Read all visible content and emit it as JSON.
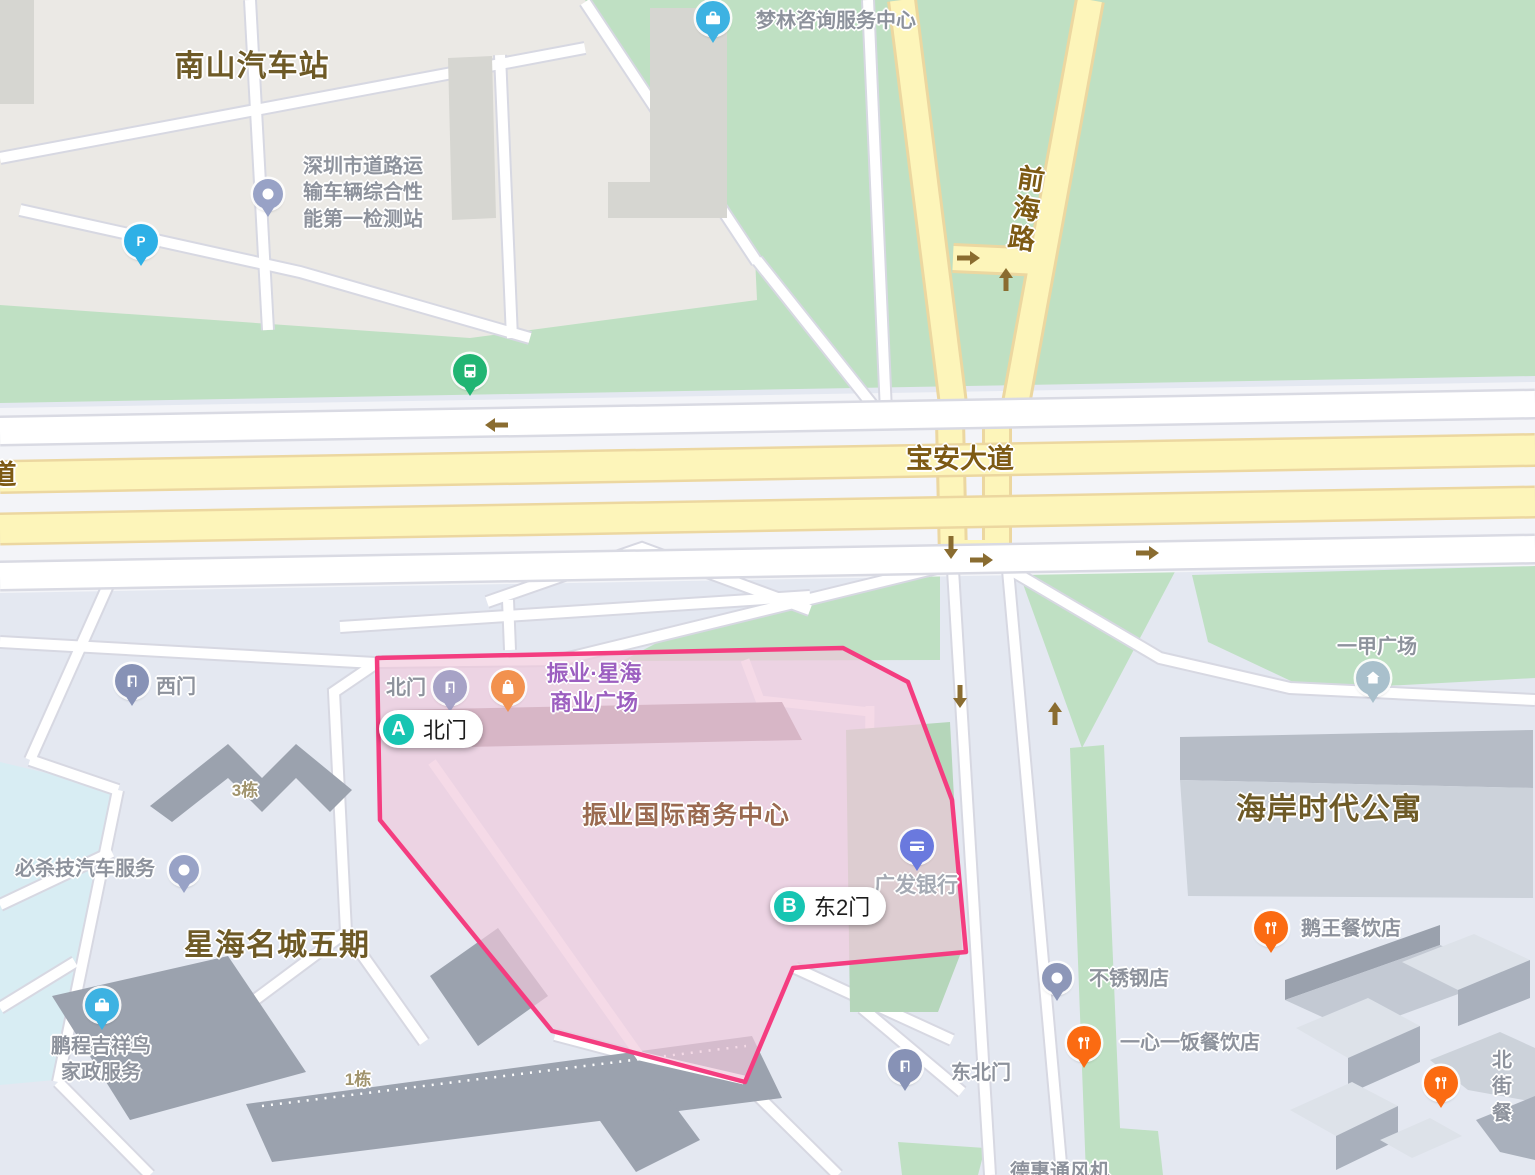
{
  "map": {
    "colors": {
      "selection_border": "#f43d80",
      "selection_fill": "#f0c8dc",
      "route_badge_teal": "#17c5b2",
      "green_area": "#bfe0c3",
      "yellow_road": "#fdf5ba",
      "brown_label": "#6e5a26"
    },
    "selected_area": {
      "name": "振业国际商务中心"
    },
    "labels": [
      {
        "name": "nanshan-bus-station",
        "text": "南山汽车站",
        "x": 252,
        "y": 67,
        "cls": "lbl-brown"
      },
      {
        "name": "baoan-avenue-road",
        "text": "宝安大道",
        "x": 960,
        "y": 460,
        "cls": "lbl-road"
      },
      {
        "name": "qianhai-road",
        "text": "前海路",
        "x": 1023,
        "y": 209,
        "cls": "lbl-road vert"
      },
      {
        "name": "partial-road-char",
        "text": "道",
        "x": 3,
        "y": 476,
        "cls": "lbl-road"
      },
      {
        "name": "zhenye-intl-business-center",
        "text": "振业国际商务中心",
        "x": 686,
        "y": 816,
        "cls": "lbl-redbrown"
      },
      {
        "name": "xinghai-mingcheng-phase5",
        "text": "星海名城五期",
        "x": 277,
        "y": 946,
        "cls": "lbl-brown"
      },
      {
        "name": "haian-times-apartment",
        "text": "海岸时代公寓",
        "x": 1329,
        "y": 810,
        "cls": "lbl-brown"
      },
      {
        "name": "building-3",
        "text": "3栋",
        "x": 245,
        "y": 791,
        "cls": "lbl-tan"
      },
      {
        "name": "building-1",
        "text": "1栋",
        "x": 358,
        "y": 1080,
        "cls": "lbl-tan"
      },
      {
        "name": "dehui-ventilator",
        "text": "德惠通风机",
        "x": 1060,
        "y": 1172,
        "cls": "lbl-gray"
      }
    ],
    "pois": [
      {
        "name": "menglin-consulting",
        "icon": "briefcase",
        "color": "#3db2e2",
        "x": 713,
        "y": 45,
        "label": "梦林咨询服务中心",
        "lx": 836,
        "ly": 21,
        "lcls": "lbl-gray"
      },
      {
        "name": "vehicle-inspection-station",
        "icon": "dot",
        "color": "#98a2c6",
        "small": true,
        "x": 268,
        "y": 219,
        "label": "深圳市道路运\n输车辆综合性\n能第一检测站",
        "lx": 363,
        "ly": 193,
        "lcls": "lbl-gray"
      },
      {
        "name": "parking",
        "icon": "P",
        "color": "#2eb0e6",
        "x": 141,
        "y": 268,
        "label": ""
      },
      {
        "name": "bus-stop",
        "icon": "bus",
        "color": "#21b573",
        "x": 470,
        "y": 398,
        "label": ""
      },
      {
        "name": "zhenye-xinghai-plaza",
        "icon": "bag",
        "color": "#f2914e",
        "x": 508,
        "y": 714,
        "label": "振业·星海\n商业广场",
        "lx": 594,
        "ly": 688,
        "lcls": "lbl-purple"
      },
      {
        "name": "north-gate",
        "icon": "door",
        "color": "#a6a2c6",
        "x": 450,
        "y": 714,
        "label": "北门",
        "lx": 406,
        "ly": 688,
        "lcls": "lbl-gray"
      },
      {
        "name": "west-gate",
        "icon": "door",
        "color": "#8792b6",
        "x": 132,
        "y": 708,
        "label": "西门",
        "lx": 176,
        "ly": 687,
        "lcls": "lbl-gray"
      },
      {
        "name": "guangfa-bank",
        "icon": "card",
        "color": "#6a79de",
        "x": 917,
        "y": 873,
        "label": "广发银行",
        "lx": 916,
        "ly": 886,
        "lcls": "lbl-lightgray"
      },
      {
        "name": "bishaji-auto-service",
        "icon": "dot",
        "color": "#98a2c6",
        "small": true,
        "x": 184,
        "y": 895,
        "label": "必杀技汽车服务",
        "lx": 85,
        "ly": 869,
        "lcls": "lbl-gray"
      },
      {
        "name": "pengcheng-housekeeping",
        "icon": "briefcase",
        "color": "#3db2e2",
        "x": 102,
        "y": 1032,
        "label": "鹏程吉祥鸟\n家政服务",
        "lx": 101,
        "ly": 1060,
        "lcls": "lbl-gray"
      },
      {
        "name": "northeast-gate",
        "icon": "door",
        "color": "#8792b6",
        "x": 905,
        "y": 1093,
        "label": "东北门",
        "lx": 981,
        "ly": 1073,
        "lcls": "lbl-gray"
      },
      {
        "name": "stainless-steel-shop",
        "icon": "dot",
        "color": "#8d97b8",
        "small": true,
        "x": 1057,
        "y": 1003,
        "label": "不锈钢店",
        "lx": 1129,
        "ly": 979,
        "lcls": "lbl-gray"
      },
      {
        "name": "goose-king-restaurant",
        "icon": "fork",
        "color": "#fb6b12",
        "x": 1271,
        "y": 955,
        "label": "鹅王餐饮店",
        "lx": 1351,
        "ly": 929,
        "lcls": "lbl-gray"
      },
      {
        "name": "yixinyifan-restaurant",
        "icon": "fork",
        "color": "#fb6b12",
        "x": 1084,
        "y": 1070,
        "label": "一心一饭餐饮店",
        "lx": 1190,
        "ly": 1043,
        "lcls": "lbl-gray"
      },
      {
        "name": "beijie-restaurant",
        "icon": "fork",
        "color": "#fb6b12",
        "x": 1441,
        "y": 1110,
        "label": "北街餐",
        "lx": 1502,
        "ly": 1087,
        "lcls": "lbl-gray"
      },
      {
        "name": "yijia-plaza",
        "icon": "house",
        "color": "#a9c0cc",
        "x": 1373,
        "y": 705,
        "label": "一甲广场",
        "lx": 1377,
        "ly": 647,
        "lcls": "lbl-gray"
      }
    ],
    "route_markers": [
      {
        "name": "marker-a",
        "letter": "A",
        "label": "北门",
        "x": 379,
        "y": 710
      },
      {
        "name": "marker-b",
        "letter": "B",
        "label": "东2门",
        "x": 770,
        "y": 887
      }
    ]
  }
}
